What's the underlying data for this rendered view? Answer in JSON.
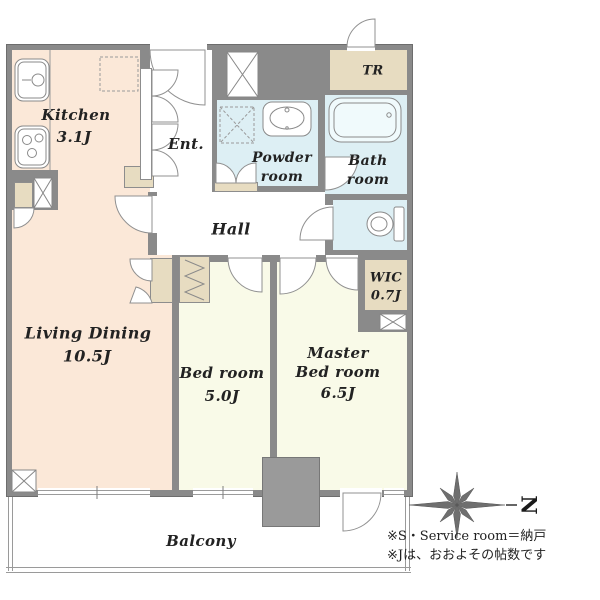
{
  "title": "apartment floor plan",
  "rooms": {
    "kitchen": {
      "name": "Kitchen",
      "size": "3.1J"
    },
    "entrance": {
      "name": "Ent."
    },
    "powder": {
      "line1": "Powder",
      "line2": "room"
    },
    "bath": {
      "line1": "Bath",
      "line2": "room"
    },
    "trunk": {
      "name": "TR"
    },
    "hall": {
      "name": "Hall"
    },
    "wic": {
      "name": "WIC",
      "size": "0.7J"
    },
    "living": {
      "name": "Living Dining",
      "size": "10.5J"
    },
    "bedroom": {
      "name": "Bed room",
      "size": "5.0J"
    },
    "master": {
      "line1": "Master",
      "line2": "Bed room",
      "size": "6.5J"
    },
    "balcony": {
      "name": "Balcony"
    }
  },
  "compass": {
    "label": "N"
  },
  "notes": [
    "※S・Service room＝納戸",
    "※Jは、おおよその帖数です"
  ],
  "colors": {
    "floor_ldk": "#fbe8d8",
    "floor_bedroom": "#f9fae8",
    "floor_wet": "#ddeff4",
    "floor_storage": "#e7dcc1",
    "wall": "#8a8a8a"
  }
}
